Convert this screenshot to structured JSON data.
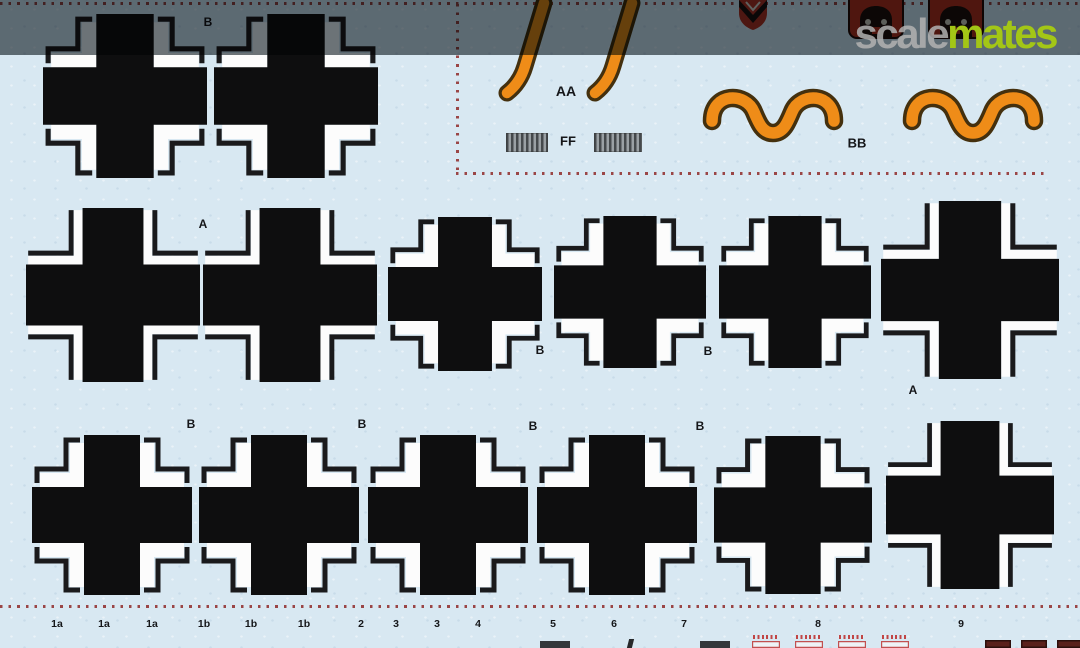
{
  "photo": {
    "top_bar_color": "#6d7478",
    "top_bar_height": 55
  },
  "watermark": {
    "scale": "scale",
    "mates": "mates",
    "scale_color": "rgba(178,178,178,0.85)",
    "mates_color": "#a3c616"
  },
  "sheet": {
    "background": "#d8e8f2",
    "dotted_color": "#9a4646",
    "cross_black": "#0e0e0f",
    "cross_white": "#fcfcfc",
    "outline_dark": "#1a1a1c",
    "orange": "#ef8c18",
    "orange_outline": "#44300e",
    "label_ink": "#151619"
  },
  "top_section": {
    "numerals_label": "AA",
    "stripes_label": "FF",
    "waves_label": "BB",
    "numerals_label_pos": {
      "x": 566,
      "y": 91
    },
    "stripes_label_pos": {
      "x": 568,
      "y": 141
    },
    "waves_label_pos": {
      "x": 857,
      "y": 143
    }
  },
  "layout": {
    "dotted_lines": [
      {
        "o": "h",
        "x": 0,
        "y": 2,
        "l": 1080
      },
      {
        "o": "v",
        "x": 456,
        "y": 4,
        "l": 168
      },
      {
        "o": "h",
        "x": 456,
        "y": 172,
        "l": 591
      },
      {
        "o": "h",
        "x": 0,
        "y": 605,
        "l": 1080
      }
    ]
  },
  "decals": {
    "crosses": [
      {
        "x": 125,
        "y": 96,
        "s": 164,
        "t": 1
      },
      {
        "x": 296,
        "y": 96,
        "s": 164,
        "t": 1
      },
      {
        "x": 113,
        "y": 295,
        "s": 174,
        "t": 2
      },
      {
        "x": 290,
        "y": 295,
        "s": 174,
        "t": 2
      },
      {
        "x": 465,
        "y": 294,
        "s": 154,
        "t": 1
      },
      {
        "x": 630,
        "y": 292,
        "s": 152,
        "t": 1
      },
      {
        "x": 795,
        "y": 292,
        "s": 152,
        "t": 1
      },
      {
        "x": 970,
        "y": 290,
        "s": 178,
        "t": 2
      },
      {
        "x": 112,
        "y": 515,
        "s": 160,
        "t": 1
      },
      {
        "x": 279,
        "y": 515,
        "s": 160,
        "t": 1
      },
      {
        "x": 448,
        "y": 515,
        "s": 160,
        "t": 1
      },
      {
        "x": 617,
        "y": 515,
        "s": 160,
        "t": 1
      },
      {
        "x": 793,
        "y": 515,
        "s": 158,
        "t": 1
      },
      {
        "x": 970,
        "y": 505,
        "s": 168,
        "t": 2
      }
    ],
    "letter_markers": [
      {
        "t": "B",
        "x": 208,
        "y": 22
      },
      {
        "t": "A",
        "x": 203,
        "y": 224
      },
      {
        "t": "B",
        "x": 540,
        "y": 350
      },
      {
        "t": "B",
        "x": 708,
        "y": 351
      },
      {
        "t": "A",
        "x": 913,
        "y": 390
      },
      {
        "t": "B",
        "x": 191,
        "y": 424
      },
      {
        "t": "B",
        "x": 362,
        "y": 424
      },
      {
        "t": "B",
        "x": 533,
        "y": 426
      },
      {
        "t": "B",
        "x": 700,
        "y": 426
      }
    ],
    "numeral_strokes": [
      {
        "x": 498,
        "y": 0,
        "w": 62,
        "h": 102
      },
      {
        "x": 586,
        "y": 0,
        "w": 62,
        "h": 102
      }
    ],
    "stripe_rects": [
      {
        "x": 506,
        "y": 133,
        "w": 42,
        "h": 19
      },
      {
        "x": 594,
        "y": 133,
        "w": 48,
        "h": 19
      }
    ],
    "waves": [
      {
        "x": 704,
        "y": 84,
        "w": 138,
        "h": 57
      },
      {
        "x": 904,
        "y": 84,
        "w": 138,
        "h": 57
      }
    ],
    "top_partials": [
      {
        "k": "shield",
        "x": 737,
        "w": 32,
        "h": 30
      },
      {
        "k": "crest",
        "x": 848,
        "w": 56,
        "h": 38
      },
      {
        "k": "crest",
        "x": 928,
        "w": 56,
        "h": 38
      }
    ],
    "bottom_labels": [
      {
        "t": "1a",
        "x": 57
      },
      {
        "t": "1a",
        "x": 104
      },
      {
        "t": "1a",
        "x": 152
      },
      {
        "t": "1b",
        "x": 204
      },
      {
        "t": "1b",
        "x": 251
      },
      {
        "t": "1b",
        "x": 304
      },
      {
        "t": "2",
        "x": 361
      },
      {
        "t": "3",
        "x": 396
      },
      {
        "t": "3",
        "x": 437
      },
      {
        "t": "4",
        "x": 478
      },
      {
        "t": "5",
        "x": 553
      },
      {
        "t": "6",
        "x": 614
      },
      {
        "t": "7",
        "x": 684
      },
      {
        "t": "8",
        "x": 818
      },
      {
        "t": "9",
        "x": 961
      }
    ],
    "bottom_labels_y": 624,
    "bottom_partials": [
      {
        "k": "dark",
        "x": 540,
        "w": 30
      },
      {
        "k": "tick",
        "x": 628,
        "w": 5
      },
      {
        "k": "dark",
        "x": 700,
        "w": 30
      },
      {
        "k": "redbox",
        "x": 752,
        "w": 28
      },
      {
        "k": "redbox",
        "x": 795,
        "w": 28
      },
      {
        "k": "redbox",
        "x": 838,
        "w": 28
      },
      {
        "k": "redbox",
        "x": 881,
        "w": 28
      },
      {
        "k": "maroon",
        "x": 985,
        "w": 26
      },
      {
        "k": "maroon",
        "x": 1021,
        "w": 26
      },
      {
        "k": "maroon",
        "x": 1057,
        "w": 26
      }
    ]
  }
}
